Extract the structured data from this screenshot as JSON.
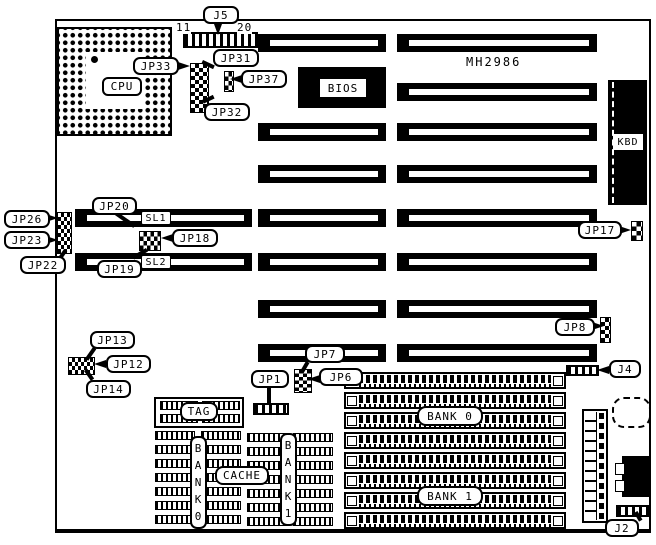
{
  "figure": {
    "model": "MH2986",
    "description": "Motherboard jumper and connector location diagram"
  },
  "callouts": {
    "j5": "J5",
    "jp33": "JP33",
    "jp31": "JP31",
    "jp37": "JP37",
    "jp32": "JP32",
    "jp26": "JP26",
    "jp23": "JP23",
    "jp22": "JP22",
    "jp20": "JP20",
    "jp18": "JP18",
    "jp19": "JP19",
    "jp17": "JP17",
    "jp8": "JP8",
    "j4": "J4",
    "jp13": "JP13",
    "jp12": "JP12",
    "jp14": "JP14",
    "jp7": "JP7",
    "jp6": "JP6",
    "jp1": "JP1",
    "j2": "J2"
  },
  "components": {
    "cpu": "CPU",
    "bios": "BIOS",
    "kbd": "KBD",
    "sl1": "SL1",
    "sl2": "SL2",
    "tag": "TAG",
    "cache": "CACHE",
    "bank0": "BANK 0",
    "bank1": "BANK 1",
    "bank0_vertical": "BANK0",
    "bank1_vertical": "BANK1",
    "model": "MH2986"
  },
  "pin_labels": {
    "j5_first": "11",
    "j5_last": "20"
  }
}
